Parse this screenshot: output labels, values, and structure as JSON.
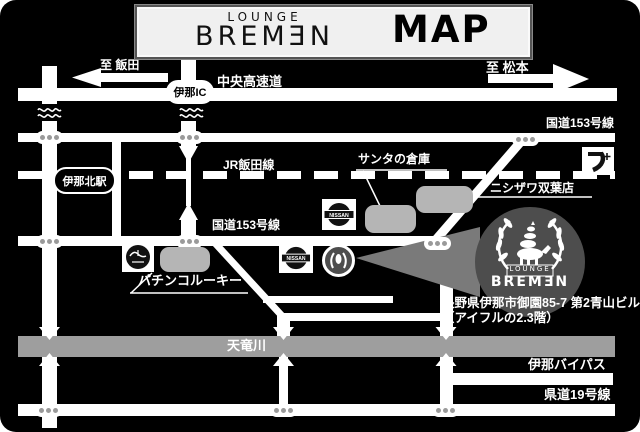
{
  "title": {
    "lounge": "LOUNGE",
    "brand": "BREMƎN",
    "map": "MAP"
  },
  "top": {
    "to_iida": "至 飯田",
    "to_matsumoto": "至 松本",
    "expressway": "中央高速道",
    "ina_ic": "伊那IC"
  },
  "roads": {
    "route153_ne": "国道153号線",
    "route153_mid": "国道153号線",
    "jr_line": "JR飯田線",
    "ina_bypass": "伊那バイパス",
    "route19": "県道19号線",
    "river": "天竜川"
  },
  "places": {
    "station": "伊那北駅",
    "santa_warehouse": "サンタの倉庫",
    "nishizawa": "ニシザワ双葉店",
    "pachinko_rookie": "パチンコルーキー",
    "nissan": "NISSAN"
  },
  "venue": {
    "logo_lounge": "LOUNGE",
    "logo_name": "BREMƎN",
    "address_line1": "長野県伊那市御園85-7 第2青山ビル",
    "address_line2": "（アイフルの2.3階）"
  },
  "colors": {
    "bg": "#000000",
    "road": "#ffffff",
    "river": "#9e9e9e",
    "building": "#b5b5b5",
    "callout": "#7a7a7a",
    "logo_circle": "#4d4d4d",
    "title_bg": "#f0f0f0"
  }
}
